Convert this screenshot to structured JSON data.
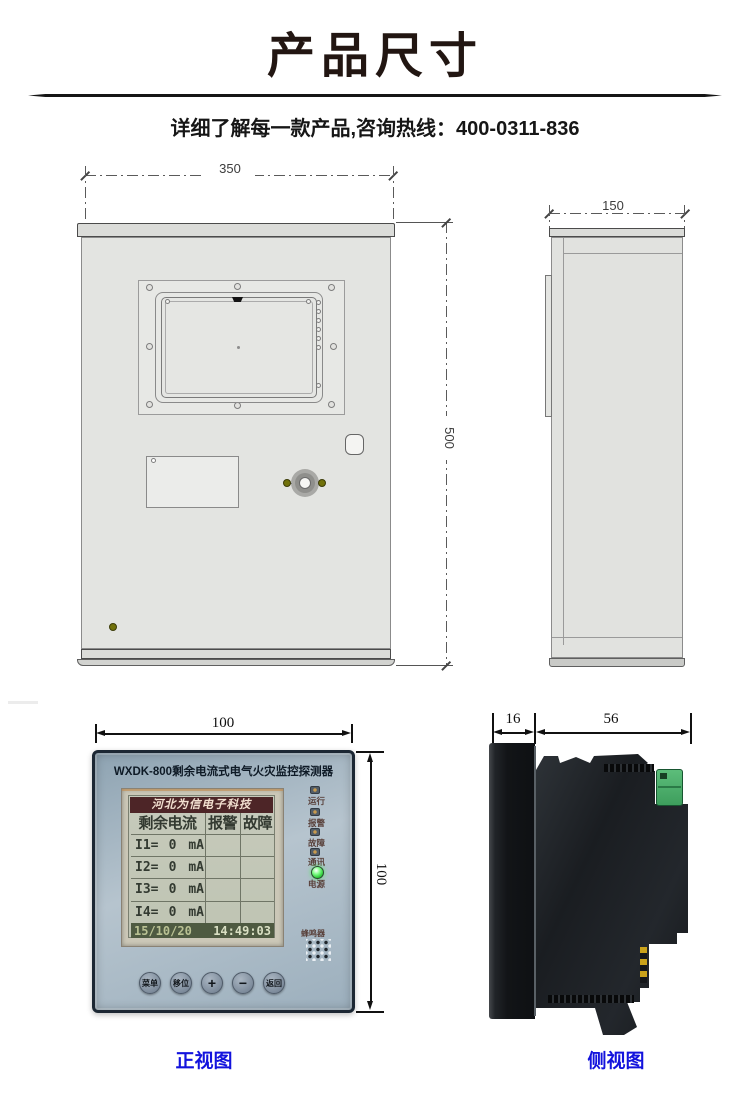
{
  "header": {
    "title": "产品尺寸",
    "subtitle": "详细了解每一款产品,咨询热线：400-0311-836"
  },
  "cabinet": {
    "front": {
      "width_mm": "350",
      "height_mm": "500"
    },
    "side": {
      "depth_mm": "150"
    }
  },
  "device": {
    "front": {
      "width_mm": "100",
      "height_mm": "100",
      "panel_title": "WXDK-800剩余电流式电气火灾监控探测器",
      "lcd": {
        "brand": "河北为信电子科技",
        "header": [
          "剩余电流",
          "报警",
          "故障"
        ],
        "rows": [
          {
            "ch": "I1=",
            "val": "0",
            "unit": "mA"
          },
          {
            "ch": "I2=",
            "val": "0",
            "unit": "mA"
          },
          {
            "ch": "I3=",
            "val": "0",
            "unit": "mA"
          },
          {
            "ch": "I4=",
            "val": "0",
            "unit": "mA"
          }
        ],
        "date": "15/10/20",
        "time": "14:49:03"
      },
      "leds": [
        {
          "label": "运行"
        },
        {
          "label": "报警"
        },
        {
          "label": "故障"
        },
        {
          "label": "通讯"
        },
        {
          "label": "电源",
          "lit": true
        }
      ],
      "buzzer_label": "蜂鸣器",
      "buttons": [
        "菜单",
        "移位",
        "+",
        "−",
        "返回"
      ],
      "caption": "正视图"
    },
    "side": {
      "bezel_mm": "16",
      "depth_mm": "56",
      "caption": "侧视图"
    }
  },
  "colors": {
    "caption_blue": "#1313dd",
    "power_led_green": "#2ecb3a",
    "terminal_green": "#4aab68",
    "lcd_brand_bg": "#4d2527",
    "lcd_footer_bg": "#4e5a41",
    "indicator_dot_olive": "#71710a"
  }
}
